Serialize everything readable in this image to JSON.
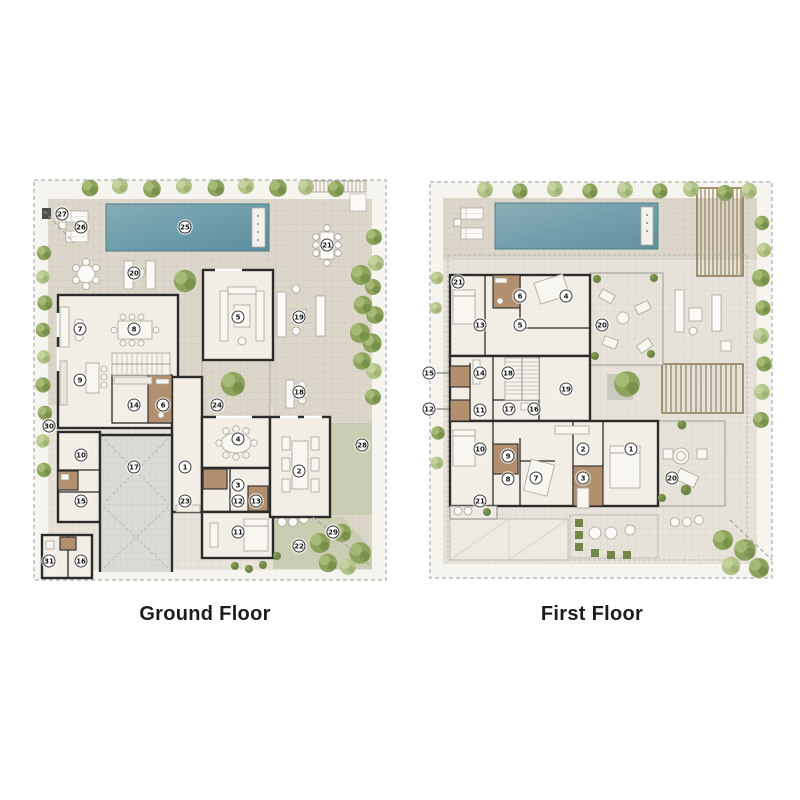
{
  "sheet": {
    "background": "#ffffff"
  },
  "colors": {
    "pool": "#6e9dab",
    "paving": "#dcd7ca",
    "paving_light": "#e7e3da",
    "wall": "#2b2b2b",
    "room_fill": "#f2eee5",
    "wet_area": "#b28f6e",
    "lawn": "#c9cdb1",
    "greenery": "#8da35c",
    "pergola": "#8c7c57",
    "marker_background": "#ffffff",
    "marker_border": "#3a3a3a",
    "label_text": "#1c1c1c"
  },
  "floors": [
    {
      "id": "ground",
      "label": "Ground Floor",
      "markers": [
        {
          "n": "27",
          "x": 32,
          "y": 39
        },
        {
          "n": "26",
          "x": 51,
          "y": 52
        },
        {
          "n": "25",
          "x": 155,
          "y": 52
        },
        {
          "n": "21",
          "x": 297,
          "y": 70
        },
        {
          "n": "20",
          "x": 104,
          "y": 98
        },
        {
          "n": "7",
          "x": 50,
          "y": 154
        },
        {
          "n": "8",
          "x": 104,
          "y": 154
        },
        {
          "n": "5",
          "x": 208,
          "y": 142
        },
        {
          "n": "19",
          "x": 269,
          "y": 142
        },
        {
          "n": "9",
          "x": 50,
          "y": 205
        },
        {
          "n": "14",
          "x": 104,
          "y": 230
        },
        {
          "n": "6",
          "x": 133,
          "y": 230
        },
        {
          "n": "24",
          "x": 187,
          "y": 230
        },
        {
          "n": "18",
          "x": 269,
          "y": 217
        },
        {
          "n": "30",
          "x": 19,
          "y": 251
        },
        {
          "n": "10",
          "x": 51,
          "y": 280
        },
        {
          "n": "17",
          "x": 104,
          "y": 292
        },
        {
          "n": "1",
          "x": 155,
          "y": 292
        },
        {
          "n": "4",
          "x": 208,
          "y": 264
        },
        {
          "n": "2",
          "x": 269,
          "y": 296
        },
        {
          "n": "28",
          "x": 332,
          "y": 270
        },
        {
          "n": "15",
          "x": 51,
          "y": 326
        },
        {
          "n": "23",
          "x": 155,
          "y": 326
        },
        {
          "n": "3",
          "x": 208,
          "y": 310
        },
        {
          "n": "12",
          "x": 208,
          "y": 326
        },
        {
          "n": "13",
          "x": 226,
          "y": 326
        },
        {
          "n": "11",
          "x": 208,
          "y": 357
        },
        {
          "n": "22",
          "x": 269,
          "y": 371
        },
        {
          "n": "29",
          "x": 303,
          "y": 357
        },
        {
          "n": "31",
          "x": 19,
          "y": 386
        },
        {
          "n": "16",
          "x": 51,
          "y": 386
        }
      ]
    },
    {
      "id": "first",
      "label": "First Floor",
      "markers": [
        {
          "n": "21",
          "x": 33,
          "y": 104
        },
        {
          "n": "6",
          "x": 95,
          "y": 118
        },
        {
          "n": "4",
          "x": 141,
          "y": 118
        },
        {
          "n": "13",
          "x": 55,
          "y": 147
        },
        {
          "n": "5",
          "x": 95,
          "y": 147
        },
        {
          "n": "20",
          "x": 177,
          "y": 147
        },
        {
          "n": "15",
          "x": 4,
          "y": 195
        },
        {
          "n": "14",
          "x": 55,
          "y": 195
        },
        {
          "n": "18",
          "x": 83,
          "y": 195
        },
        {
          "n": "19",
          "x": 141,
          "y": 211
        },
        {
          "n": "12",
          "x": 4,
          "y": 231
        },
        {
          "n": "11",
          "x": 55,
          "y": 232
        },
        {
          "n": "17",
          "x": 84,
          "y": 231
        },
        {
          "n": "16",
          "x": 109,
          "y": 231
        },
        {
          "n": "10",
          "x": 55,
          "y": 271
        },
        {
          "n": "2",
          "x": 158,
          "y": 271
        },
        {
          "n": "1",
          "x": 206,
          "y": 271
        },
        {
          "n": "9",
          "x": 83,
          "y": 278
        },
        {
          "n": "8",
          "x": 83,
          "y": 301
        },
        {
          "n": "7",
          "x": 111,
          "y": 300
        },
        {
          "n": "3",
          "x": 158,
          "y": 300
        },
        {
          "n": "20",
          "x": 247,
          "y": 300
        },
        {
          "n": "21",
          "x": 55,
          "y": 323
        }
      ]
    }
  ]
}
